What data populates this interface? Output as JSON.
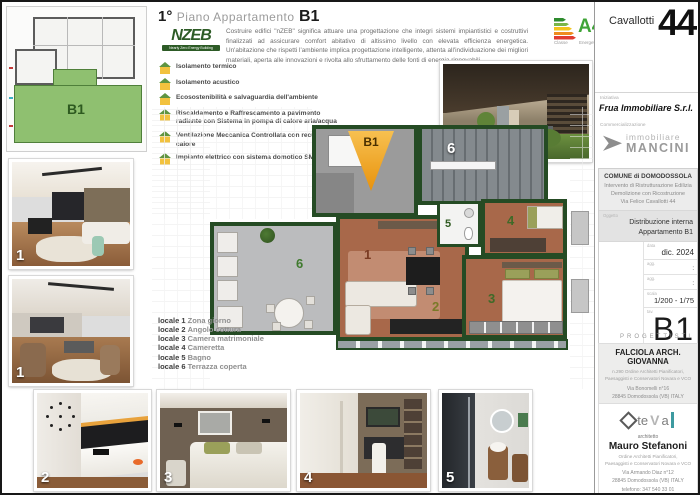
{
  "title": {
    "floor": "1°",
    "middle": "Piano Appartamento",
    "unit": "B1"
  },
  "nzeb": {
    "logo_word": "NZEB",
    "logo_tagline": "Nearly Zero Energy Building",
    "description": "Costruire edifici \"nZEB\" significa attuare una progettazione che integri sistemi impiantistici e costruttivi finalizzati ad assicurare comfort abitativo di altissimo livello con elevata efficienza energetica. Un'abitazione che rispetti l'ambiente implica progettazione intelligente, attenta all'individuazione dei migliori materiali, aperta alle innovazioni e rivolta allo sfruttamento delle fonti di energia rinnovabili."
  },
  "features": [
    "Isolamento termico",
    "Isolamento acustico",
    "Ecosostenibilità e salvaguardia dell'ambiente",
    "Riscaldamento e Raffrescamento a pavimento radiante con Sistema in pompa di calore aria/acqua",
    "Ventilazione Meccanica Controllata con recupero del calore",
    "Impianto elettrico con sistema domotico SMART"
  ],
  "energy": {
    "class": "A4",
    "label_left": "Classe",
    "label_right": "Energetica"
  },
  "plan": {
    "marker": "B1",
    "miniplan_label": "B1",
    "numbers": {
      "living": "1",
      "kitchen": "2",
      "bedroom": "3",
      "cameretta": "4",
      "bath": "5",
      "terrace": "6"
    }
  },
  "locali": [
    {
      "label": "locale 1",
      "name": "Zona giorno"
    },
    {
      "label": "locale 2",
      "name": "Angolo cottura"
    },
    {
      "label": "locale 3",
      "name": "Camera matrimoniale"
    },
    {
      "label": "locale 4",
      "name": "Cameretta"
    },
    {
      "label": "locale 5",
      "name": "Bagno"
    },
    {
      "label": "locale 6",
      "name": "Terrazza coperta"
    }
  ],
  "photos": {
    "living_a": "1",
    "living_b": "1",
    "terrace": "6",
    "kitchen": "2",
    "bedroom": "3",
    "cameretta": "4",
    "bathroom": "5"
  },
  "sidebar": {
    "street": "Cavallotti",
    "number": "44",
    "iniziativa_label": "Iniziativa",
    "iniziativa_value": "Frua Immobiliare S.r.l.",
    "commercializzazione_label": "Commercializzazione",
    "mancini_line1": "immobiliare",
    "mancini_line2": "MANCINI",
    "comune_line1": "COMUNE di DOMODOSSOLA",
    "comune_line2": "Intervento di Ristrutturazione Edilizia",
    "comune_line3": "Demolizione con Ricostruzione",
    "comune_line4": "Via Felice Cavallotti 44",
    "oggetto_label": "Oggetto",
    "oggetto_line1": "Distribuzione interna",
    "oggetto_line2": "Appartamento B1",
    "fields": {
      "data_label": "data",
      "data_value": "dic. 2024",
      "agg1_label": "agg.",
      "agg1_value": ":",
      "agg2_label": "agg.",
      "agg2_value": ":",
      "scala_label": "scala",
      "scala_value": "1/200  -  1/75",
      "tav_label": "tav.",
      "tav_value": "B1"
    },
    "progettisti_label": "PROGETTISTI",
    "falciola": {
      "name": "FALCIOLA ARCH. GIOVANNA",
      "order1": "n.290 Ordine Architetti Pianificatori,",
      "order2": "Paesaggisti e Conservatori Novara e VCO",
      "addr1": "Via Bonomelli n°16",
      "addr2": "28845 Domodossola (VB) ITALY",
      "tel": "telefono/fax: 0324 249322",
      "email": "e-mail: falciola.giovanna@gmail.com"
    },
    "stefanoni": {
      "logo_te": "te",
      "logo_v": "V",
      "logo_a": "a",
      "role": "architetto",
      "name": "Mauro Stefanoni",
      "order1": "Ordine Architetti Pianificatori,",
      "order2": "Paesaggisti e Conservatori Novara e VCO",
      "addr1": "Via Armando Diaz n°12",
      "addr2": "28845 Domodossola (VB) ITALY",
      "tel": "telefono: 347 540 33 01",
      "email": "e-mail: mauro.stefanoni@teval.it"
    }
  }
}
